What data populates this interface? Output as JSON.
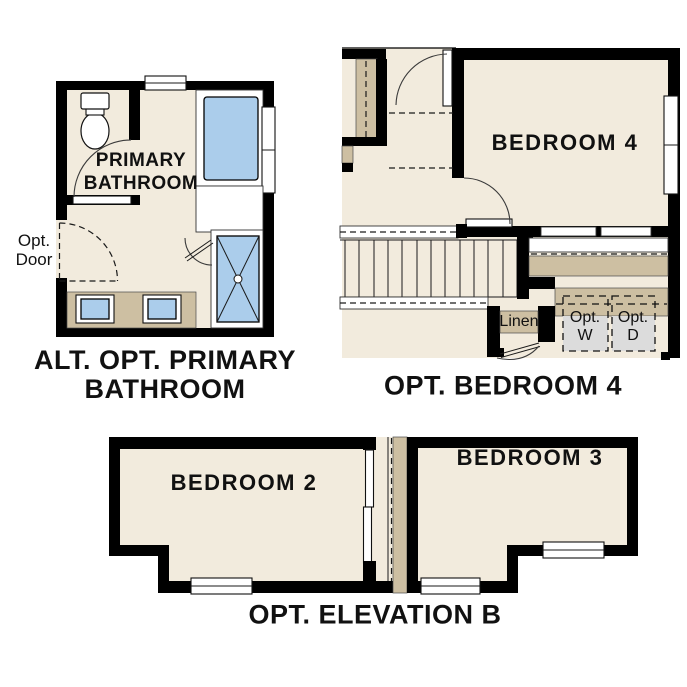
{
  "colors": {
    "background": "#ffffff",
    "wall": "#000000",
    "floor": "#f2ebdd",
    "counter_tan": "#cdbfa2",
    "fixture_blue": "#abcdeb",
    "appliance_gray": "#dcdcdc",
    "text": "#111111"
  },
  "plan_bathroom": {
    "title_line1": "ALT. OPT. PRIMARY",
    "title_line2": "BATHROOM",
    "room_line1": "PRIMARY",
    "room_line2": "BATHROOM",
    "opt_door_line1": "Opt.",
    "opt_door_line2": "Door"
  },
  "plan_bedroom4": {
    "title": "OPT. BEDROOM 4",
    "room": "BEDROOM 4",
    "linen": "Linen",
    "washer_line1": "Opt.",
    "washer_line2": "W",
    "dryer_line1": "Opt.",
    "dryer_line2": "D"
  },
  "plan_elevation": {
    "title": "OPT. ELEVATION B",
    "room2": "BEDROOM 2",
    "room3": "BEDROOM 3"
  }
}
